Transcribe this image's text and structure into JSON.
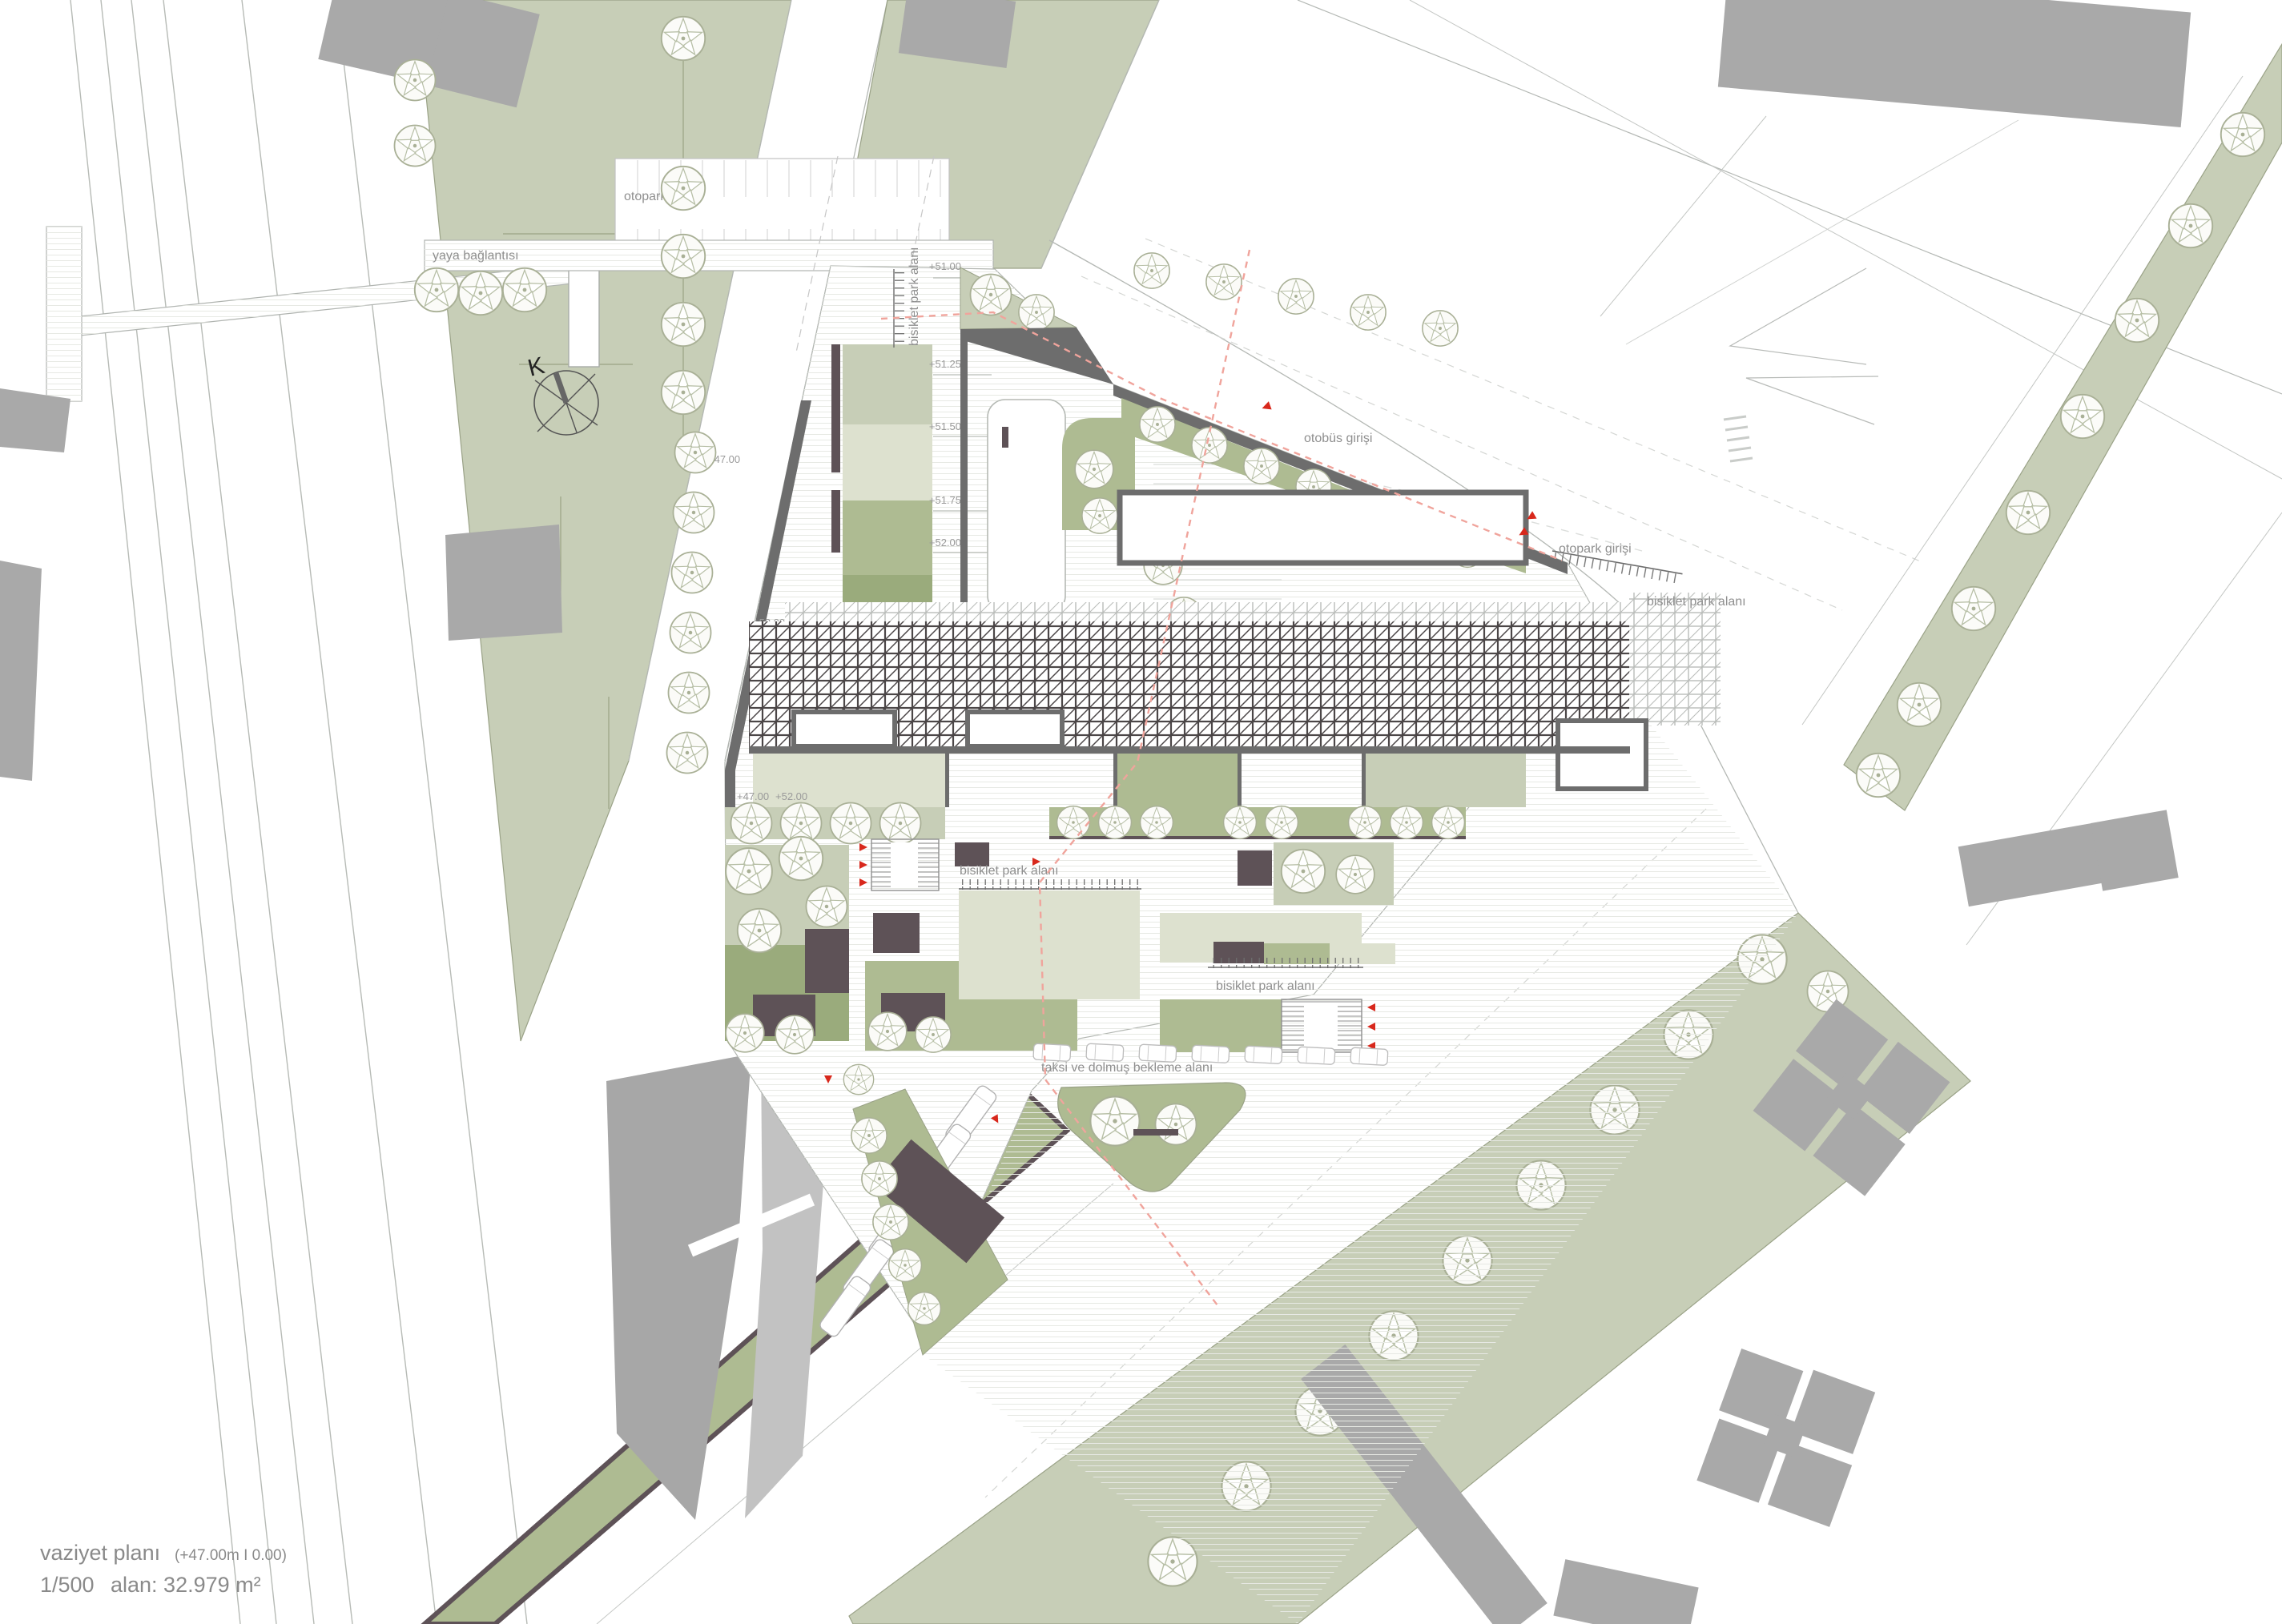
{
  "title_block": {
    "name": "vaziyet planı",
    "datum": "(+47.00m I 0.00)",
    "scale": "1/500",
    "area": "alan: 32.979 m²"
  },
  "labels": {
    "otopark": "otopark",
    "yaya_baglantisi": "yaya bağlantısı",
    "otobus_girisi": "otobüs girişi",
    "otopark_girisi": "otopark girişi",
    "bisiklet_park_alani": "bisiklet park alanı",
    "taksi_dolmus": "taksi ve dolmuş bekleme alanı",
    "north_k": "K"
  },
  "elevations": {
    "e51_00": "+51.00",
    "e51_25": "+51.25",
    "e51_50": "+51.50",
    "e51_75": "+51.75",
    "e52_00": "+52.00",
    "e47_00": "+47.00"
  },
  "colors": {
    "green_base": "#c7ceb7",
    "green_light": "#dde1cf",
    "green_mid": "#aebb92",
    "green_dark": "#9aab7c",
    "building_gray": "#a9a9a9",
    "building_light_gray": "#c2c2c2",
    "wall_dark": "#6d6d6d",
    "pavilion_dark": "#5e5257",
    "accent_red": "#d8281c"
  }
}
